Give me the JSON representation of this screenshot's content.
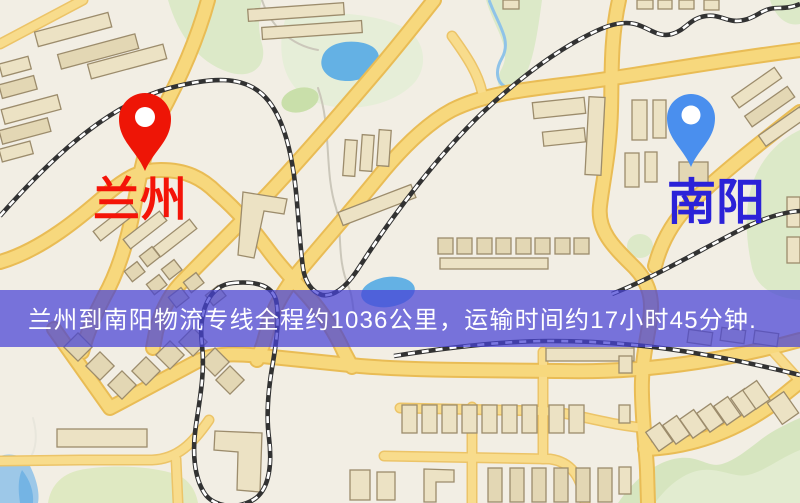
{
  "banner": {
    "text": "兰州到南阳物流专线全程约1036公里，运输时间约17小时45分钟.",
    "background": "rgba(70,66,214,0.72)",
    "text_color": "#ffffff"
  },
  "markers": {
    "origin": {
      "label": "兰州",
      "icon": "map-pin-icon",
      "pin_color": "#ee1506",
      "pin_hole_color": "#ffffff",
      "label_color": "#f41408"
    },
    "destination": {
      "label": "南阳",
      "icon": "map-pin-icon",
      "pin_color": "#4a8fee",
      "pin_hole_color": "#ffffff",
      "label_color": "#2b22d8"
    }
  },
  "map_colors": {
    "background": "#f2eee4",
    "road_major": "#f7d87d",
    "road_casing": "#e9bc55",
    "railway": "#323232",
    "building": "#ece2c4",
    "green_area": "#dce9c8",
    "water": "#64b1e4"
  }
}
